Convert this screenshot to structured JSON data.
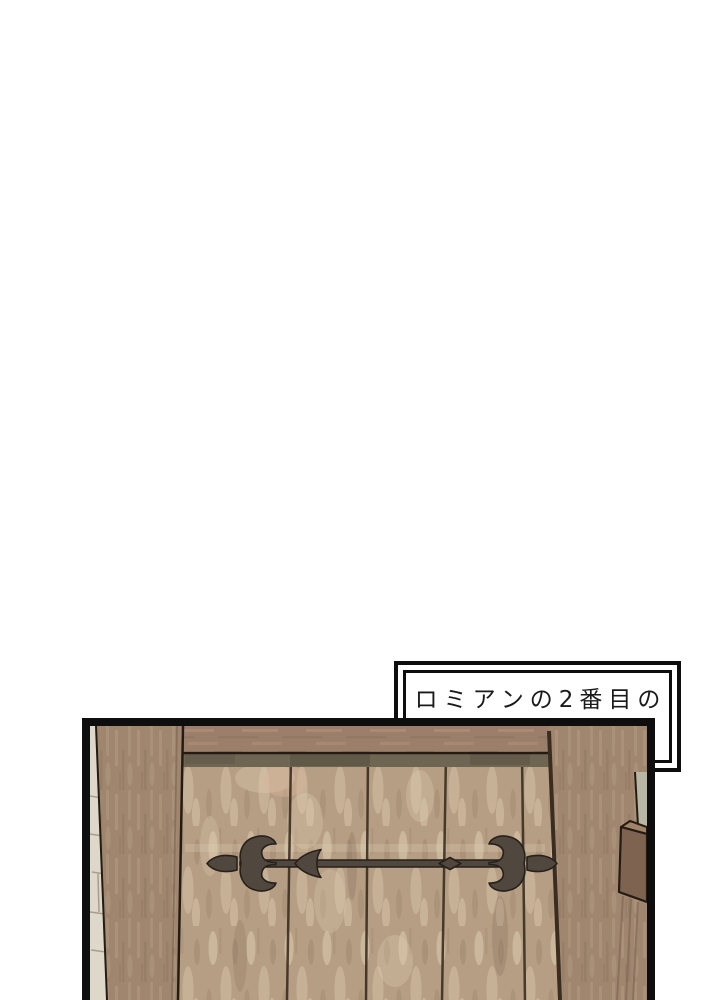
{
  "page": {
    "background_color": "#ffffff"
  },
  "caption": {
    "line1": "ロミアンの2番目の",
    "line2": "秘密基地",
    "border_color": "#0d0d0d",
    "background_color": "#ffffff",
    "text_color": "#1a1a1a"
  },
  "panel": {
    "name": "wooden-door-scene",
    "description": "Close-up of a rustic wooden door with a decorative wrought-iron strap hinge, framed by wooden posts, a sliver of stone wall on the left and a latch block on the right.",
    "border_color": "#0e0e0e",
    "palette": {
      "plank_base": "#b69e84",
      "plank_light": "#e0cfb2",
      "plank_warm": "#d9b49b",
      "plank_dark": "#7e6852",
      "post_base": "#a1866f",
      "post_light": "#bfa78f",
      "post_dark": "#806957",
      "beam_base": "#9c7f6a",
      "shadow_strip": "#6f6553",
      "shadow_dark": "#565040",
      "stone": "#ded8ca",
      "stone_line": "#a89d8b",
      "sage": "#b8b6a5",
      "block_front": "#7d6350",
      "block_top": "#a08368",
      "iron": "#50473e",
      "iron_outline": "#27211b",
      "seam": "#3a2d20",
      "outline": "#241c12"
    }
  }
}
